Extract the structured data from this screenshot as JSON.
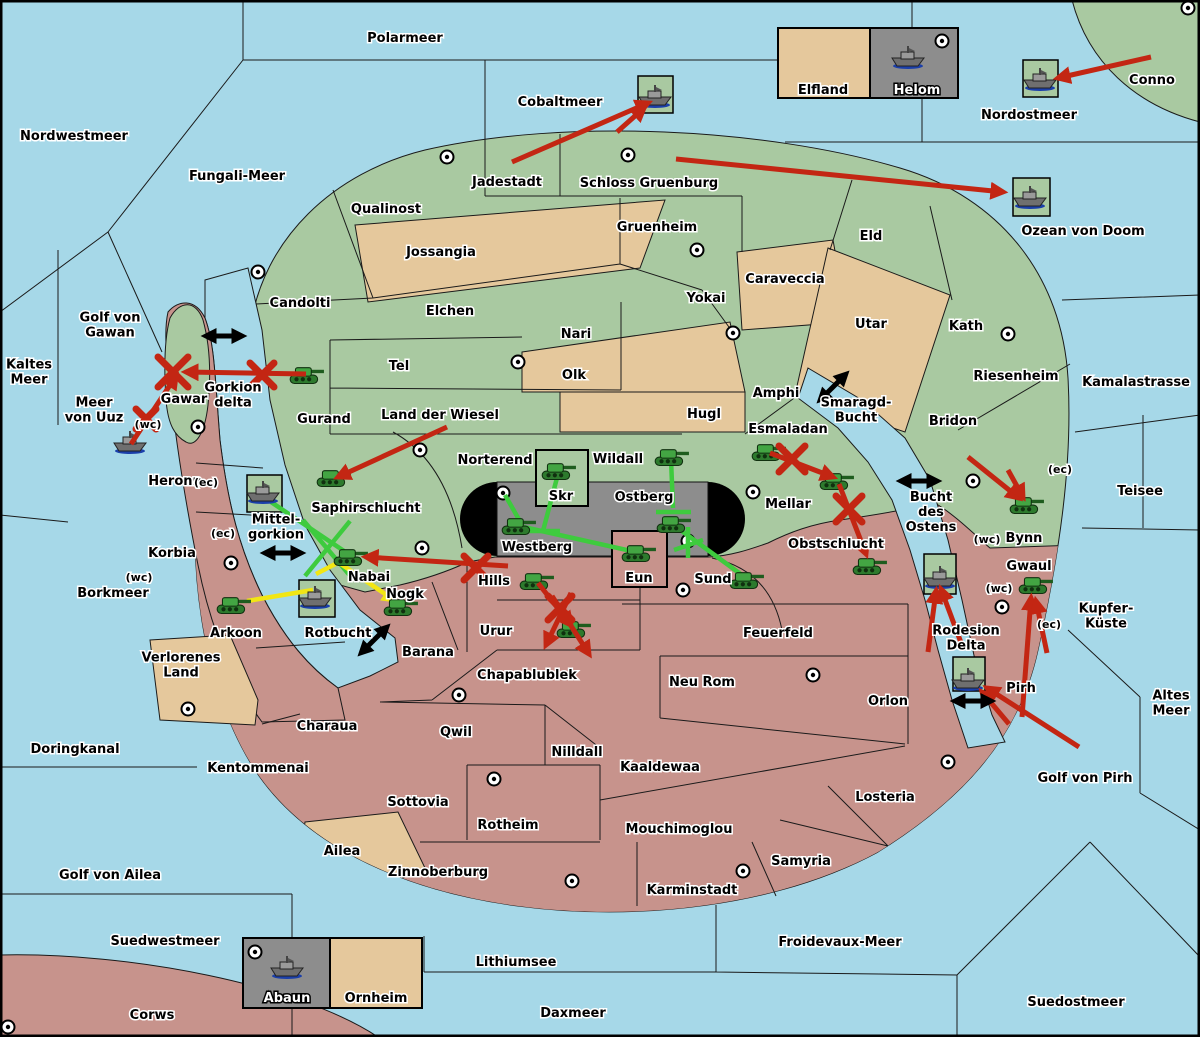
{
  "title": "Fantasy Diplomacy game map",
  "palette": {
    "sea": "#a6d8e8",
    "land_north": "#a9c9a1",
    "land_south": "#c7938c",
    "land_neutral_tan": "#e5c89c",
    "contested_gray": "#8d8d8d",
    "attack_red": "#c32613",
    "support_green": "#3ecb3e",
    "support_yellow": "#f2e613",
    "convoy_black": "#000000",
    "halo": "#ffffff"
  },
  "labels": [
    {
      "text": "Polarmeer",
      "x": 405,
      "y": 38,
      "style": "s"
    },
    {
      "text": "Nordwestmeer",
      "x": 74,
      "y": 136,
      "style": "s"
    },
    {
      "text": "Fungali-Meer",
      "x": 237,
      "y": 176,
      "style": "s"
    },
    {
      "text": "Cobaltmeer",
      "x": 560,
      "y": 102,
      "style": "s"
    },
    {
      "text": "Nordostmeer",
      "x": 1029,
      "y": 115,
      "style": "s"
    },
    {
      "text": "Conno",
      "x": 1152,
      "y": 80,
      "style": "l"
    },
    {
      "text": "Ozean von Doom",
      "x": 1083,
      "y": 231,
      "style": "s"
    },
    {
      "text": "Kaltes\nMeer",
      "x": 29,
      "y": 372,
      "style": "s"
    },
    {
      "text": "Golf von\nGawan",
      "x": 110,
      "y": 325,
      "style": "s"
    },
    {
      "text": "Meer\nvon Uuz",
      "x": 94,
      "y": 410,
      "style": "s"
    },
    {
      "text": "Gorkion\ndelta",
      "x": 233,
      "y": 395,
      "style": "s"
    },
    {
      "text": "Smaragd-\nBucht",
      "x": 856,
      "y": 410,
      "style": "s"
    },
    {
      "text": "Kamalastrasse",
      "x": 1136,
      "y": 382,
      "style": "s"
    },
    {
      "text": "Teisee",
      "x": 1140,
      "y": 491,
      "style": "s"
    },
    {
      "text": "Bucht\ndes\nOstens",
      "x": 931,
      "y": 512,
      "style": "s"
    },
    {
      "text": "Kupfer-\nKüste",
      "x": 1106,
      "y": 616,
      "style": "s"
    },
    {
      "text": "Borkmeer",
      "x": 113,
      "y": 593,
      "style": "s"
    },
    {
      "text": "Altes\nMeer",
      "x": 1171,
      "y": 703,
      "style": "s"
    },
    {
      "text": "Golf von Pirh",
      "x": 1085,
      "y": 778,
      "style": "s"
    },
    {
      "text": "Doringkanal",
      "x": 75,
      "y": 749,
      "style": "s"
    },
    {
      "text": "Golf von Ailea",
      "x": 110,
      "y": 875,
      "style": "s"
    },
    {
      "text": "Suedwestmeer",
      "x": 165,
      "y": 941,
      "style": "s"
    },
    {
      "text": "Froidevaux-Meer",
      "x": 840,
      "y": 942,
      "style": "s"
    },
    {
      "text": "Lithiumsee",
      "x": 516,
      "y": 962,
      "style": "s"
    },
    {
      "text": "Daxmeer",
      "x": 573,
      "y": 1013,
      "style": "s"
    },
    {
      "text": "Suedostmeer",
      "x": 1076,
      "y": 1002,
      "style": "s"
    },
    {
      "text": "Mittel-\ngorkion",
      "x": 276,
      "y": 527,
      "style": "s"
    },
    {
      "text": "Rotbucht",
      "x": 338,
      "y": 633,
      "style": "s"
    },
    {
      "text": "Rodesion\nDelta",
      "x": 966,
      "y": 638,
      "style": "s"
    },
    {
      "text": "Corws",
      "x": 152,
      "y": 1015,
      "style": "l"
    },
    {
      "text": "Qualinost",
      "x": 386,
      "y": 209,
      "style": "l"
    },
    {
      "text": "Candolti",
      "x": 300,
      "y": 303,
      "style": "l"
    },
    {
      "text": "Jossangia",
      "x": 441,
      "y": 252,
      "style": "l"
    },
    {
      "text": "Elchen",
      "x": 450,
      "y": 311,
      "style": "l"
    },
    {
      "text": "Tel",
      "x": 399,
      "y": 366,
      "style": "l"
    },
    {
      "text": "Nari",
      "x": 576,
      "y": 334,
      "style": "l"
    },
    {
      "text": "Olk",
      "x": 574,
      "y": 375,
      "style": "l"
    },
    {
      "text": "Land der Wiesel",
      "x": 440,
      "y": 415,
      "style": "l"
    },
    {
      "text": "Hugl",
      "x": 704,
      "y": 414,
      "style": "l"
    },
    {
      "text": "Gurand",
      "x": 324,
      "y": 419,
      "style": "l"
    },
    {
      "text": "Jadestadt",
      "x": 507,
      "y": 182,
      "style": "l"
    },
    {
      "text": "Schloss Gruenburg",
      "x": 649,
      "y": 183,
      "style": "l"
    },
    {
      "text": "Gruenheim",
      "x": 657,
      "y": 227,
      "style": "l"
    },
    {
      "text": "Yokai",
      "x": 706,
      "y": 298,
      "style": "l"
    },
    {
      "text": "Caraveccia",
      "x": 785,
      "y": 279,
      "style": "l"
    },
    {
      "text": "Eld",
      "x": 871,
      "y": 236,
      "style": "l"
    },
    {
      "text": "Utar",
      "x": 871,
      "y": 324,
      "style": "l"
    },
    {
      "text": "Kath",
      "x": 966,
      "y": 326,
      "style": "l"
    },
    {
      "text": "Riesenheim",
      "x": 1016,
      "y": 376,
      "style": "l"
    },
    {
      "text": "Amphi",
      "x": 776,
      "y": 393,
      "style": "l"
    },
    {
      "text": "Bridon",
      "x": 953,
      "y": 421,
      "style": "l"
    },
    {
      "text": "Esmaladan",
      "x": 788,
      "y": 429,
      "style": "l"
    },
    {
      "text": "Mellar",
      "x": 788,
      "y": 504,
      "style": "l"
    },
    {
      "text": "Saphirschlucht",
      "x": 366,
      "y": 508,
      "style": "l"
    },
    {
      "text": "Norterend",
      "x": 495,
      "y": 460,
      "style": "l"
    },
    {
      "text": "Wildall",
      "x": 618,
      "y": 459,
      "style": "l"
    },
    {
      "text": "Skr",
      "x": 561,
      "y": 496,
      "style": "l"
    },
    {
      "text": "Ostberg",
      "x": 644,
      "y": 497,
      "style": "l"
    },
    {
      "text": "Westberg",
      "x": 537,
      "y": 547,
      "style": "l"
    },
    {
      "text": "Nabai",
      "x": 369,
      "y": 577,
      "style": "l"
    },
    {
      "text": "Eun",
      "x": 639,
      "y": 578,
      "style": "l"
    },
    {
      "text": "Sund",
      "x": 713,
      "y": 579,
      "style": "l"
    },
    {
      "text": "Gawar",
      "x": 184,
      "y": 399,
      "style": "l"
    },
    {
      "text": "Heronn",
      "x": 175,
      "y": 481,
      "style": "l"
    },
    {
      "text": "Korbia",
      "x": 172,
      "y": 553,
      "style": "l"
    },
    {
      "text": "Verlorenes\nLand",
      "x": 181,
      "y": 665,
      "style": "l"
    },
    {
      "text": "Arkoon",
      "x": 236,
      "y": 633,
      "style": "l"
    },
    {
      "text": "Nogk",
      "x": 405,
      "y": 594,
      "style": "l"
    },
    {
      "text": "Barana",
      "x": 428,
      "y": 652,
      "style": "l"
    },
    {
      "text": "Hills",
      "x": 494,
      "y": 581,
      "style": "l"
    },
    {
      "text": "Urur",
      "x": 496,
      "y": 631,
      "style": "l"
    },
    {
      "text": "Chapablublek",
      "x": 527,
      "y": 675,
      "style": "l"
    },
    {
      "text": "Qwil",
      "x": 456,
      "y": 732,
      "style": "l"
    },
    {
      "text": "Nilldall",
      "x": 577,
      "y": 752,
      "style": "l"
    },
    {
      "text": "Kaaldewaa",
      "x": 660,
      "y": 767,
      "style": "l"
    },
    {
      "text": "Rotheim",
      "x": 508,
      "y": 825,
      "style": "l"
    },
    {
      "text": "Mouchimoglou",
      "x": 679,
      "y": 829,
      "style": "l"
    },
    {
      "text": "Zinnoberburg",
      "x": 438,
      "y": 872,
      "style": "l"
    },
    {
      "text": "Karminstadt",
      "x": 692,
      "y": 890,
      "style": "l"
    },
    {
      "text": "Samyria",
      "x": 801,
      "y": 861,
      "style": "l"
    },
    {
      "text": "Losteria",
      "x": 885,
      "y": 797,
      "style": "l"
    },
    {
      "text": "Orlon",
      "x": 888,
      "y": 701,
      "style": "l"
    },
    {
      "text": "Neu Rom",
      "x": 702,
      "y": 682,
      "style": "l"
    },
    {
      "text": "Feuerfeld",
      "x": 778,
      "y": 633,
      "style": "l"
    },
    {
      "text": "Obstschlucht",
      "x": 836,
      "y": 544,
      "style": "l"
    },
    {
      "text": "Bynn",
      "x": 1024,
      "y": 538,
      "style": "l"
    },
    {
      "text": "Gwaul",
      "x": 1029,
      "y": 566,
      "style": "l"
    },
    {
      "text": "Pirh",
      "x": 1021,
      "y": 688,
      "style": "l"
    },
    {
      "text": "Kentommenai",
      "x": 258,
      "y": 768,
      "style": "l"
    },
    {
      "text": "Charaua",
      "x": 327,
      "y": 726,
      "style": "l"
    },
    {
      "text": "Sottovia",
      "x": 418,
      "y": 802,
      "style": "l"
    },
    {
      "text": "Ailea",
      "x": 342,
      "y": 851,
      "style": "l"
    },
    {
      "text": "Elfland",
      "x": 823,
      "y": 90,
      "style": "l"
    },
    {
      "text": "Ornheim",
      "x": 376,
      "y": 998,
      "style": "l"
    },
    {
      "text": "Helom",
      "x": 917,
      "y": 90,
      "style": "i"
    },
    {
      "text": "Abaun",
      "x": 287,
      "y": 998,
      "style": "i"
    },
    {
      "text": "(wc)",
      "x": 148,
      "y": 424,
      "style": "c"
    },
    {
      "text": "(ec)",
      "x": 206,
      "y": 482,
      "style": "c"
    },
    {
      "text": "(ec)",
      "x": 223,
      "y": 533,
      "style": "c"
    },
    {
      "text": "(wc)",
      "x": 139,
      "y": 577,
      "style": "c"
    },
    {
      "text": "(ec)",
      "x": 1060,
      "y": 469,
      "style": "c"
    },
    {
      "text": "(wc)",
      "x": 987,
      "y": 539,
      "style": "c"
    },
    {
      "text": "(wc)",
      "x": 999,
      "y": 588,
      "style": "c"
    },
    {
      "text": "(ec)",
      "x": 1049,
      "y": 624,
      "style": "c"
    }
  ],
  "supply_centers": [
    [
      447,
      157
    ],
    [
      628,
      155
    ],
    [
      1188,
      8
    ],
    [
      942,
      41
    ],
    [
      258,
      272
    ],
    [
      697,
      250
    ],
    [
      518,
      362
    ],
    [
      733,
      333
    ],
    [
      1008,
      334
    ],
    [
      198,
      427
    ],
    [
      420,
      450
    ],
    [
      503,
      493
    ],
    [
      753,
      492
    ],
    [
      973,
      481
    ],
    [
      231,
      563
    ],
    [
      422,
      548
    ],
    [
      688,
      541
    ],
    [
      683,
      590
    ],
    [
      459,
      695
    ],
    [
      188,
      709
    ],
    [
      813,
      675
    ],
    [
      948,
      762
    ],
    [
      494,
      779
    ],
    [
      572,
      881
    ],
    [
      743,
      871
    ],
    [
      1002,
      607
    ],
    [
      255,
      952
    ],
    [
      8,
      1027
    ]
  ],
  "units": [
    {
      "type": "army",
      "territory": "Gurand",
      "x": 306,
      "y": 374
    },
    {
      "type": "army",
      "territory": "Saphirschlucht",
      "x": 333,
      "y": 477
    },
    {
      "type": "army",
      "territory": "Nabai",
      "x": 350,
      "y": 556
    },
    {
      "type": "army",
      "territory": "Arkoon",
      "x": 233,
      "y": 604
    },
    {
      "type": "army",
      "territory": "Nogk",
      "x": 400,
      "y": 606
    },
    {
      "type": "army",
      "territory": "Hills",
      "x": 536,
      "y": 580
    },
    {
      "type": "army",
      "territory": "Urur",
      "x": 573,
      "y": 628
    },
    {
      "type": "army",
      "territory": "Skr",
      "x": 558,
      "y": 470
    },
    {
      "type": "army",
      "territory": "Wildall",
      "x": 671,
      "y": 456
    },
    {
      "type": "army",
      "territory": "Westberg",
      "x": 518,
      "y": 525
    },
    {
      "type": "army",
      "territory": "Ostberg",
      "x": 673,
      "y": 523
    },
    {
      "type": "army",
      "territory": "Eun",
      "x": 638,
      "y": 552
    },
    {
      "type": "army",
      "territory": "Sund",
      "x": 746,
      "y": 579
    },
    {
      "type": "army",
      "territory": "Esmaladan",
      "x": 768,
      "y": 451
    },
    {
      "type": "army",
      "territory": "Mellar",
      "x": 836,
      "y": 480
    },
    {
      "type": "army",
      "territory": "Obstschlucht",
      "x": 869,
      "y": 565
    },
    {
      "type": "army",
      "territory": "Bynn",
      "x": 1026,
      "y": 504
    },
    {
      "type": "army",
      "territory": "Gwaul",
      "x": 1035,
      "y": 584
    },
    {
      "type": "fleet",
      "territory": "Cobaltmeer",
      "x": 655,
      "y": 97
    },
    {
      "type": "fleet",
      "territory": "Nordostmeer",
      "x": 1040,
      "y": 80
    },
    {
      "type": "fleet",
      "territory": "Ozean von Doom",
      "x": 1030,
      "y": 198
    },
    {
      "type": "fleet",
      "territory": "Helom",
      "x": 908,
      "y": 58
    },
    {
      "type": "fleet",
      "territory": "Meer von Uuz",
      "x": 130,
      "y": 443
    },
    {
      "type": "fleet",
      "territory": "Mittelgorkion",
      "x": 263,
      "y": 493
    },
    {
      "type": "fleet",
      "territory": "Rotbucht",
      "x": 315,
      "y": 598
    },
    {
      "type": "fleet",
      "territory": "Bucht des Ostens",
      "x": 940,
      "y": 578
    },
    {
      "type": "fleet",
      "territory": "Rodesion Delta",
      "x": 968,
      "y": 680
    },
    {
      "type": "fleet",
      "territory": "Abaun",
      "x": 287,
      "y": 968
    }
  ],
  "unit_boxes": [
    [
      638,
      76,
      35,
      37
    ],
    [
      1023,
      60,
      35,
      37
    ],
    [
      1013,
      178,
      37,
      38
    ],
    [
      247,
      475,
      35,
      37
    ],
    [
      299,
      580,
      36,
      37
    ],
    [
      924,
      554,
      32,
      40
    ],
    [
      953,
      657,
      32,
      34
    ]
  ],
  "named_boxes": [
    {
      "label": "Elfland",
      "x": 778,
      "y": 28,
      "w": 92,
      "h": 70,
      "fill": "tan"
    },
    {
      "label": "Helom",
      "x": 870,
      "y": 28,
      "w": 88,
      "h": 70,
      "fill": "gray"
    },
    {
      "label": "Abaun",
      "x": 243,
      "y": 938,
      "w": 87,
      "h": 70,
      "fill": "gray"
    },
    {
      "label": "Ornheim",
      "x": 330,
      "y": 938,
      "w": 92,
      "h": 70,
      "fill": "tan"
    },
    {
      "label": "Skr",
      "x": 536,
      "y": 450,
      "w": 52,
      "h": 56,
      "fill": "green"
    },
    {
      "label": "Eun",
      "x": 612,
      "y": 531,
      "w": 55,
      "h": 56,
      "fill": "pink"
    }
  ],
  "orders": {
    "attacks_red": [
      [
        512,
        162,
        648,
        103
      ],
      [
        617,
        132,
        644,
        108
      ],
      [
        676,
        159,
        1003,
        192
      ],
      [
        1151,
        57,
        1058,
        78
      ],
      [
        306,
        374,
        186,
        372
      ],
      [
        131,
        444,
        176,
        376
      ],
      [
        447,
        427,
        338,
        477
      ],
      [
        770,
        453,
        833,
        477
      ],
      [
        839,
        484,
        866,
        554
      ],
      [
        968,
        457,
        1019,
        498
      ],
      [
        1008,
        470,
        1023,
        497
      ],
      [
        1022,
        717,
        1031,
        598
      ],
      [
        1047,
        653,
        1036,
        601
      ],
      [
        1079,
        747,
        987,
        688
      ],
      [
        1009,
        724,
        982,
        692
      ],
      [
        963,
        648,
        941,
        589
      ],
      [
        928,
        652,
        936,
        591
      ],
      [
        538,
        583,
        571,
        625
      ],
      [
        571,
        593,
        546,
        645
      ],
      [
        552,
        596,
        589,
        654
      ],
      [
        508,
        566,
        366,
        557
      ]
    ],
    "supports_green": [
      [
        271,
        502,
        344,
        551
      ],
      [
        303,
        520,
        352,
        578
      ],
      [
        305,
        576,
        350,
        521
      ],
      [
        558,
        474,
        543,
        531
      ],
      [
        527,
        531,
        560,
        531
      ],
      [
        505,
        495,
        521,
        523
      ],
      [
        519,
        526,
        636,
        552
      ],
      [
        671,
        459,
        673,
        508
      ],
      [
        656,
        512,
        691,
        512
      ],
      [
        675,
        526,
        746,
        578
      ],
      [
        688,
        527,
        688,
        558
      ],
      [
        674,
        550,
        703,
        540
      ]
    ],
    "supports_yellow": [
      [
        247,
        601,
        313,
        590,
        false
      ],
      [
        316,
        574,
        343,
        560,
        false
      ],
      [
        335,
        560,
        394,
        600,
        true
      ]
    ],
    "sea_links_black": [
      [
        224,
        336,
        0
      ],
      [
        833,
        387,
        -45
      ],
      [
        919,
        481,
        0
      ],
      [
        283,
        553,
        0
      ],
      [
        374,
        640,
        -45
      ],
      [
        973,
        701,
        0
      ]
    ],
    "failed_x_red": [
      [
        173,
        372,
        30
      ],
      [
        262,
        375,
        24
      ],
      [
        146,
        419,
        20
      ],
      [
        792,
        459,
        26
      ],
      [
        849,
        509,
        26
      ],
      [
        476,
        568,
        24
      ],
      [
        560,
        608,
        24
      ]
    ]
  }
}
